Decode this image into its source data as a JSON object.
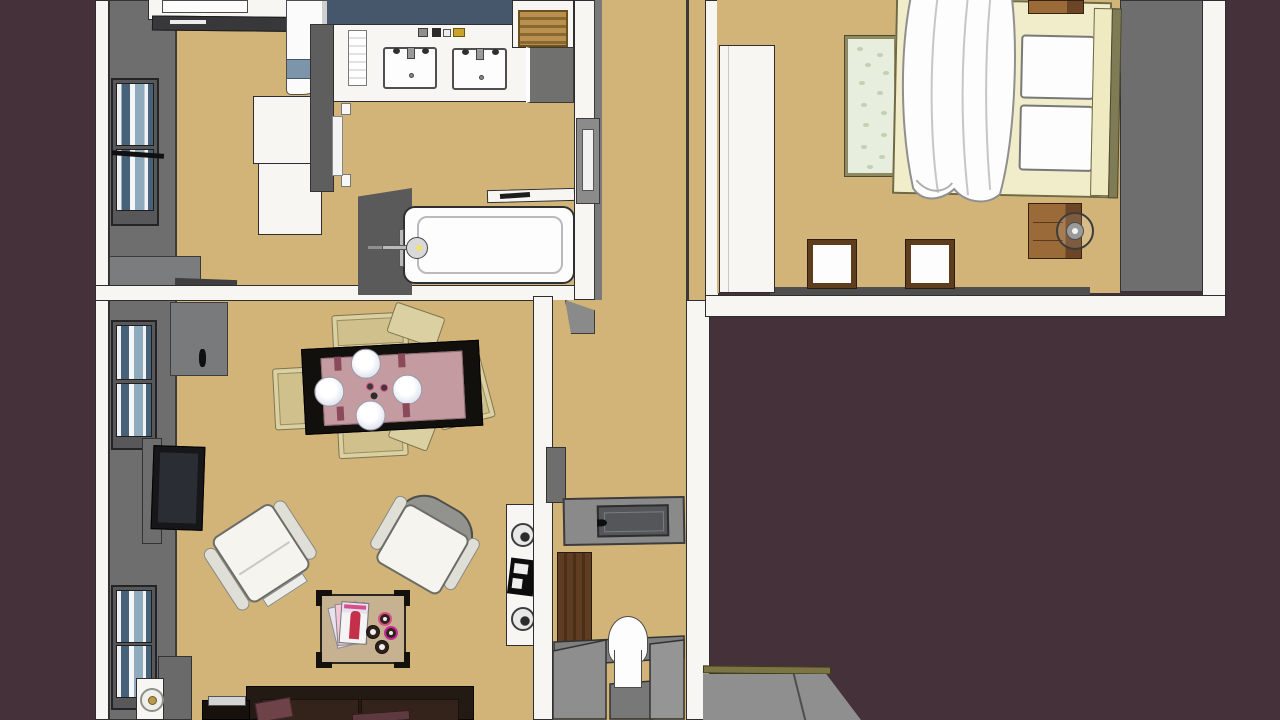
{
  "scene": {
    "title": "3D top-down floor plan rendering of an apartment",
    "style": "SketchUp-like architectural model, bird's-eye view",
    "units": [
      {
        "name": "main-unit",
        "rooms": [
          "kitchen",
          "bathroom",
          "living-dining-room",
          "hallway"
        ]
      },
      {
        "name": "bedroom-unit",
        "rooms": [
          "bedroom"
        ]
      }
    ]
  },
  "palette": {
    "background": "#45313a",
    "floor_tan": "#d3b478",
    "wall_white": "#f7f6f2",
    "wall_gray": "#6e6e6e",
    "wall_gray_dark": "#58585a",
    "slate_wall": "#46566b",
    "window_glass": "#46617a",
    "window_glass_light": "#8fa9bd",
    "sofa_brown": "#241a14",
    "pillow_maroon": "#6d4348",
    "table_black": "#12100d",
    "runner_mauve": "#c49ba1",
    "chair_cream": "#dbd0a2",
    "coffee_table_tan": "#c6b190",
    "wood_door": "#5f3d22",
    "wood_nightstand": "#9a6a38",
    "basket_wicker": "#b9904e",
    "bed_frame_cream": "#f1edca",
    "bench_green": "#e7eedd",
    "olive_trim": "#7f7b55",
    "steps_gray": "#8b8b8b",
    "platform_olive": "#7c7444",
    "magazine_red": "#c4304a",
    "coaster_pink": "#d94f8a"
  },
  "inventory": {
    "kitchen": [
      "counter",
      "cooktop-appliance",
      "dark-countertop",
      "refrigerator",
      "white-cabinets"
    ],
    "bathroom": [
      "vanity-counter",
      "sink-left",
      "sink-right",
      "toiletries",
      "hand-towel",
      "wicker-basket",
      "vanity-cabinet",
      "wall-shelf",
      "bathtub",
      "tub-faucet"
    ],
    "living_dining": [
      "dining-table",
      "table-runner",
      "dinner-plates-x4",
      "napkins",
      "candles",
      "dining-chairs-x5",
      "sideboard",
      "tv",
      "tv-stand",
      "armchair-left",
      "armchair-right",
      "coffee-table",
      "magazines",
      "coasters-x4",
      "sofa",
      "sofa-pillows",
      "side-table",
      "lamp-table",
      "table-lamp",
      "media-unit"
    ],
    "hallway": [
      "floor-hatch-landing",
      "wood-door",
      "toilet",
      "stair-steps"
    ],
    "bedroom": [
      "wardrobe",
      "bed",
      "duvet",
      "pillows-x2",
      "headboard",
      "tufted-bench",
      "floor-cushions-x2",
      "nightstand",
      "round-lamp",
      "top-side-table"
    ]
  }
}
